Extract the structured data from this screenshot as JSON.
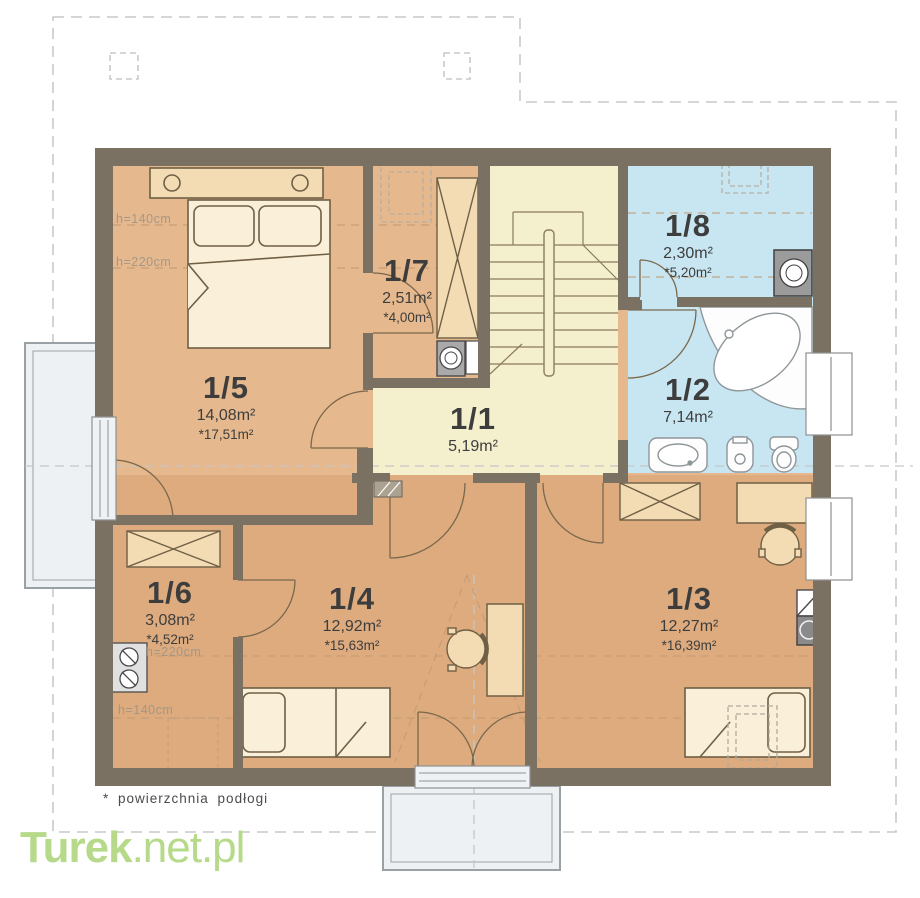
{
  "title": "attic floor plan",
  "rooms": {
    "r1": {
      "num": "1/1",
      "area": "5,19m²"
    },
    "r2": {
      "num": "1/2",
      "area": "7,14m²"
    },
    "r3": {
      "num": "1/3",
      "area": "12,27m²",
      "floor": "*16,39m²"
    },
    "r4": {
      "num": "1/4",
      "area": "12,92m²",
      "floor": "*15,63m²"
    },
    "r5": {
      "num": "1/5",
      "area": "14,08m²",
      "floor": "*17,51m²"
    },
    "r6": {
      "num": "1/6",
      "area": "3,08m²",
      "floor": "*4,52m²"
    },
    "r7": {
      "num": "1/7",
      "area": "2,51m²",
      "floor": "*4,00m²"
    },
    "r8": {
      "num": "1/8",
      "area": "2,30m²",
      "floor": "*5,20m²"
    }
  },
  "heights": {
    "r5_a": "h=140cm",
    "r5_b": "h=220cm",
    "r6_a": "h=220cm",
    "r6_b": "h=140cm"
  },
  "footnote": "* powierzchnia podłogi",
  "watermark": {
    "bold": "Turek",
    "rest": ".net.pl"
  },
  "palette": {
    "wall": "#7b7163",
    "room_warm_top": "#e5b88e",
    "room_warm_bottom": "#ddab7e",
    "room_blue": "#c8e6f2",
    "room_cream": "#f4efcd",
    "furniture_fill": "#f3dcb4",
    "linen_fill": "#faf0da",
    "balcony_fill": "#edf1f3",
    "roof_dash": "#c9c9c9",
    "slope_dash": "#c29b73",
    "watermark_green": "#b6da8a",
    "label_text": "#3d3d3d"
  }
}
